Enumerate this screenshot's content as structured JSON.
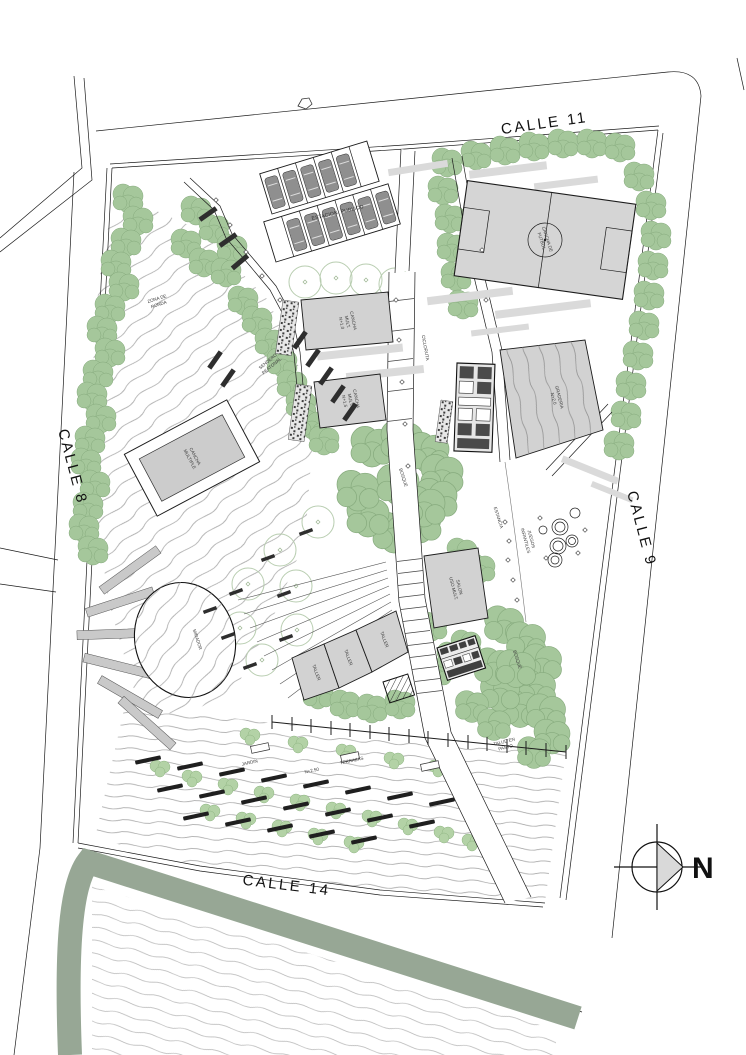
{
  "drawing": {
    "title": "Plano general de parque urbano",
    "streets": {
      "top": "CALLE 11",
      "left": "CALLE 8",
      "right": "CALLE 9",
      "bottom": "CALLE 14"
    },
    "north": {
      "label": "N"
    },
    "labels": {
      "parking": "ESTACION. PUBLICO",
      "soccer1": "CANCHA DE",
      "soccer2": "FUTBOL",
      "court_left1": "CANCHA",
      "court_left2": "MULTIPLE",
      "court_a1": "CANCHA",
      "court_a2": "MULT.",
      "court_a3": "N+1.0",
      "court_b1": "CANCHA",
      "court_b2": "MULT.",
      "court_b3": "N+1.5",
      "graderia1": "GRADERIA",
      "graderia2": "N+2.0",
      "salon1": "SALON",
      "salon2": "USO MULT.",
      "taller": "TALLER",
      "cicloruta": "CICLORUTA",
      "sendero1": "SENDERO",
      "sendero2": "PEATONAL",
      "ronda1": "ZONA DE",
      "ronda2": "RONDA",
      "bosque": "BOSQUE",
      "juegos1": "JUEGOS",
      "juegos2": "INFANTILES",
      "estancia": "ESTANCIA",
      "mirador": "MIRADOR",
      "talud1": "TALUD EN",
      "talud2": "PASTO",
      "jardin": "JARDIN",
      "terrazas": "TERRAZAS",
      "nivel": "N+2.50"
    },
    "colors": {
      "tree_green": "#a5c79b",
      "shrub_green": "#b3d2a6",
      "band_green": "#97a795",
      "building_gray": "#d2d2d2",
      "field_gray": "#d5d5d5",
      "car_gray": "#8f8f8f",
      "shadow_gray": "#dadada",
      "contour_gray": "#a9a9a9",
      "line_black": "#1c1c1c"
    }
  }
}
